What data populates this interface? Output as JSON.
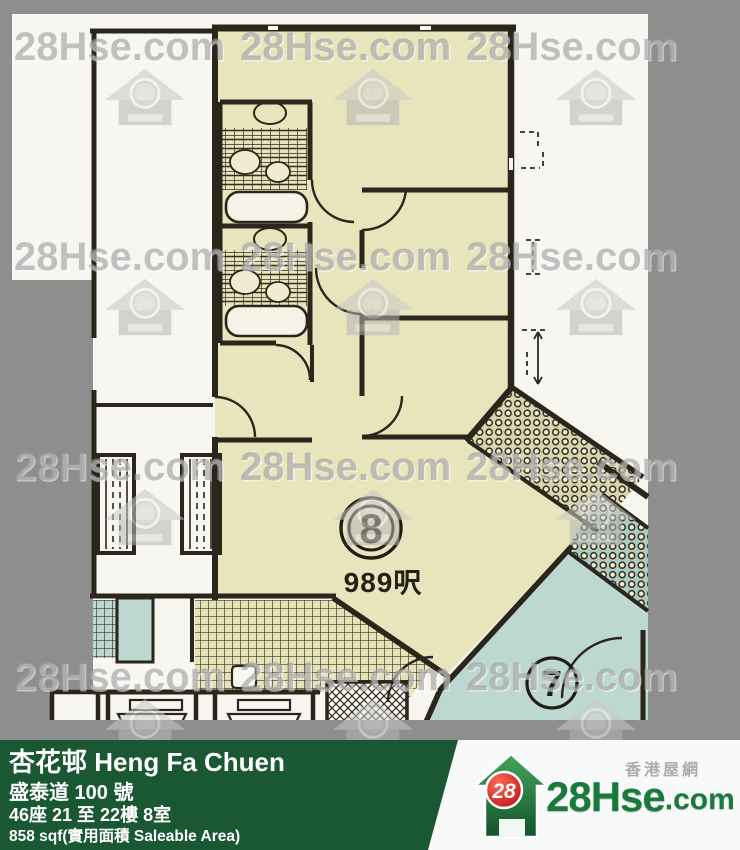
{
  "watermark": {
    "text": "28Hse.com",
    "logo_number": "28"
  },
  "plan": {
    "unit_label": "8",
    "unit_area": "989呎",
    "adjacent_unit_label": "7"
  },
  "footer": {
    "estate_name": "杏花邨 Heng Fa Chuen",
    "street_address": "盛泰道 100 號",
    "block_floor_flat": "46座 21 至 22樓 8室",
    "saleable_area": "858 sqf(實用面積 Saleable Area)",
    "brand": {
      "logo_number": "28",
      "brand_name": "28Hse",
      "brand_suffix": ".com",
      "tagline": "香港屋網"
    }
  },
  "colors": {
    "frame_gray": "#8e8e8e",
    "scan_white": "#f8f6f1",
    "unit8_cream": "#e8e4bc",
    "unit7_teal": "#bcd8d1",
    "wall_ink": "#2a261b",
    "footer_green": "#1a5733",
    "brand_green": "#187a3b",
    "logo_red": "#cf1317"
  }
}
